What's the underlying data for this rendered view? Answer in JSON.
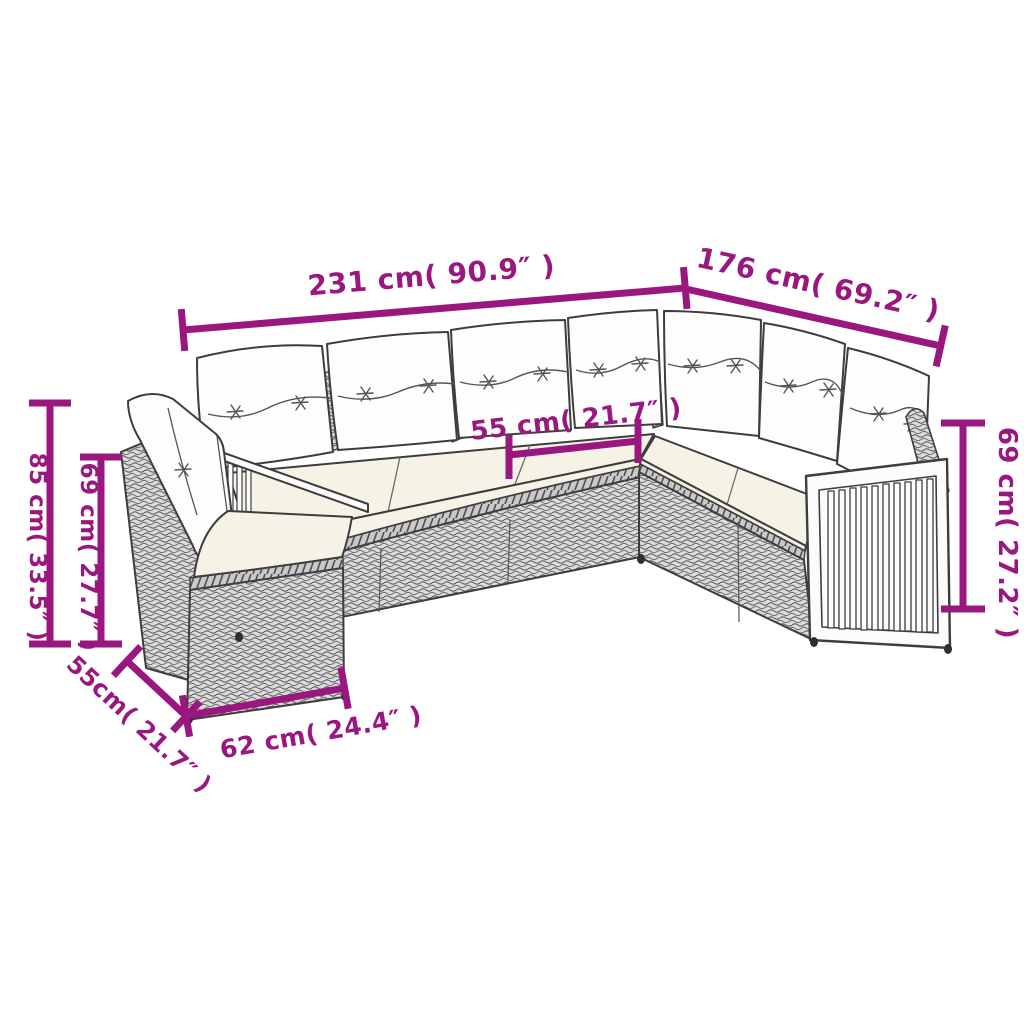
{
  "colors": {
    "dimension_magenta": "#9A1780",
    "cushion_cream": "#F6F3E6",
    "pillow_white": "#FDFDFB",
    "rattan_gray": "#DCDCDC",
    "rattan_line": "#5E5E5E",
    "outline": "#3D3D3D",
    "background": "#FFFFFF"
  },
  "dimensions": {
    "total_width": {
      "label": "231 cm( 90.9″ )",
      "cm": 231,
      "inches": 90.9
    },
    "right_section_width": {
      "label": "176 cm( 69.2″ )",
      "cm": 176,
      "inches": 69.2
    },
    "seat_width": {
      "label": "55 cm( 21.7″ )",
      "cm": 55,
      "inches": 21.7
    },
    "back_height_outer_left": {
      "label": "85 cm( 33.5″ )",
      "cm": 85,
      "inches": 33.5
    },
    "back_height_inner_left": {
      "label": "69 cm( 27.7″ )",
      "cm": 69,
      "inches": 27.7
    },
    "back_height_right": {
      "label": "69 cm( 27.2″ )",
      "cm": 69,
      "inches": 27.2
    },
    "ottoman_depth": {
      "label": "55cm( 21.7″ )",
      "cm": 55,
      "inches": 21.7
    },
    "ottoman_width": {
      "label": "62 cm( 24.4″ )",
      "cm": 62,
      "inches": 24.4
    }
  }
}
